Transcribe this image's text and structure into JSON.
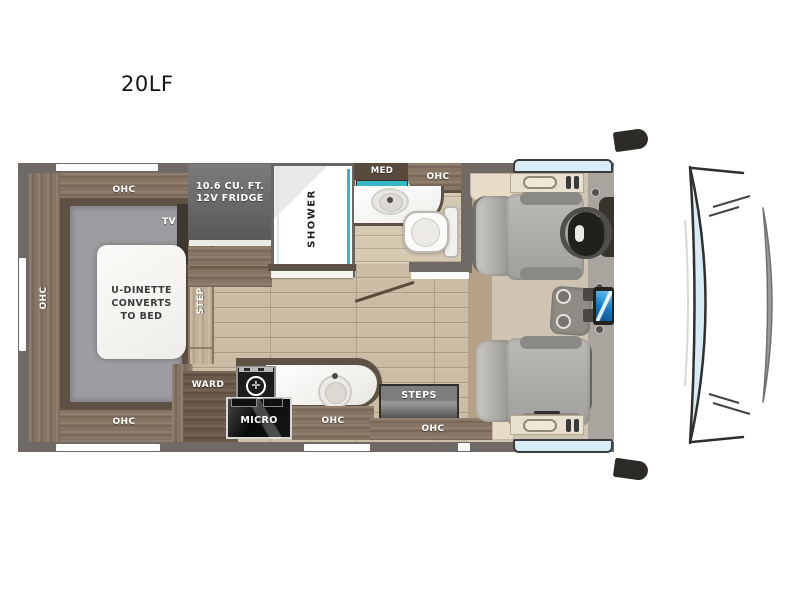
{
  "title": "20LF",
  "floorplan": {
    "labels": {
      "ohc_top_left": "OHC",
      "ohc_left_side": "OHC",
      "ohc_bottom_left": "OHC",
      "ohc_bath": "OHC",
      "ohc_kitchen": "OHC",
      "ohc_entry": "OHC",
      "tv": "TV",
      "step": "STEP",
      "ward": "WARD",
      "micro": "MICRO",
      "steps": "STEPS",
      "med": "MED",
      "shower": "SHOWER",
      "dinette_line1": "U-DINETTE",
      "dinette_line2": "CONVERTS",
      "dinette_line3": "TO BED",
      "fridge_line1": "10.6 CU. FT.",
      "fridge_line2": "12V FRIDGE"
    },
    "icons": {
      "burner": "✛"
    },
    "colors": {
      "wall": "#6f6a66",
      "wood": "#877463",
      "wood_trim": "#5e5244",
      "floor": "#cbbca5",
      "deck_gray": "#9d9da1",
      "teal_accent": "#35b9c6",
      "fridge_gray": "#6a6a6a",
      "screen_blue": "#1279c6",
      "window_blue": "#d8ecf7",
      "cab_floor": "#cfc3b1",
      "seat_gray": "#aaa8a5",
      "micro_black": "#111111"
    }
  }
}
